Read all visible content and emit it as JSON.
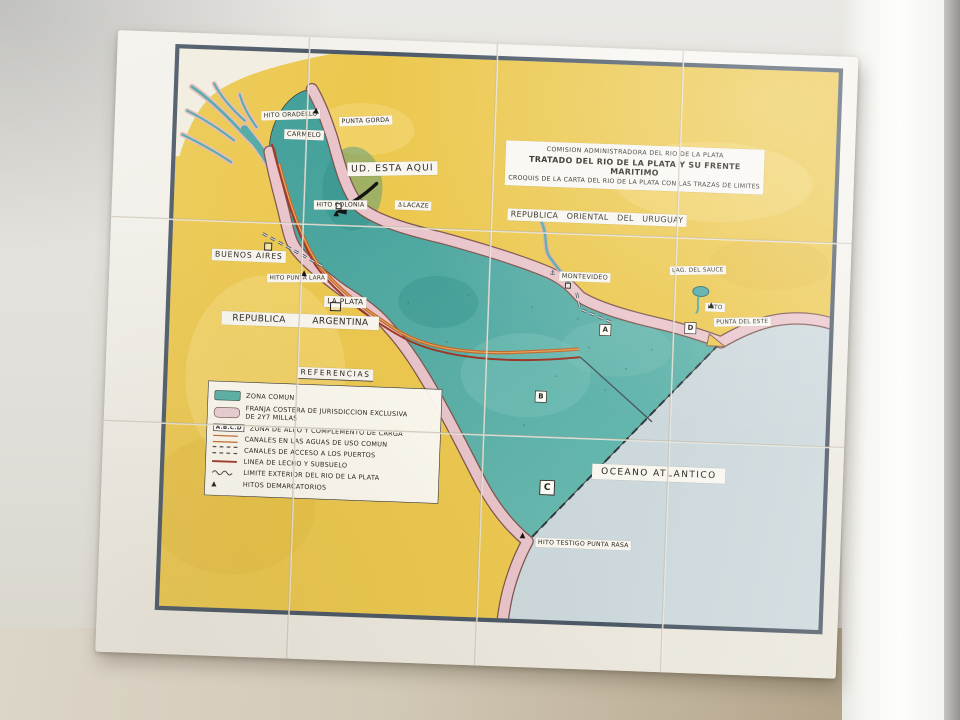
{
  "mural": {
    "title_box": {
      "line1": "COMISION ADMINISTRADORA DEL RIO DE LA PLATA",
      "line2": "TRATADO DEL RIO DE LA PLATA Y SU FRENTE MARITIMO",
      "line3": "CROQUIS DE LA CARTA DEL RIO DE LA PLATA CON LAS TRAZAS DE LIMITES"
    },
    "labels": {
      "republica_oriental": "REPUBLICA ORIENTAL DEL URUGUAY",
      "republica_argentina": "REPUBLICA ARGENTINA",
      "buenos_aires": "BUENOS AIRES",
      "hito_punta_lara": "HITO PUNTA LARA",
      "la_plata": "LA PLATA",
      "hito_oradello": "HITO ORADELLO",
      "punta_gorda": "PUNTA GORDA",
      "carmelo": "CARMELO",
      "ud_esta_aqui": "UD. ESTA AQUI",
      "hito_colonia": "HITO COLONIA",
      "lacaze": "LACAZE",
      "montevideo": "MONTEVIDEO",
      "lag_del_sauce": "LAG. DEL SAUCE",
      "hito_punta_del_este": "HITO",
      "punta_del_este": "PUNTA DEL ESTE",
      "oceano_atlantico": "OCEANO ATLANTICO",
      "hito_testigo_punta_rasa": "HITO TESTIGO PUNTA RASA"
    },
    "zone_markers": {
      "a": "A",
      "b": "B",
      "c": "C",
      "d": "D"
    },
    "icons": {
      "hito": "▲",
      "anchor": "⚓"
    },
    "legend": {
      "title": "REFERENCIAS",
      "abcd_box": "A.B.C.D",
      "items": [
        {
          "label": "ZONA COMUN"
        },
        {
          "label": "FRANJA COSTERA DE JURISDICCION EXCLUSIVA",
          "label2": "DE 2Y7 MILLAS"
        },
        {
          "label": "ZONA DE ALIJO Y COMPLEMENTO DE CARGA"
        },
        {
          "label": "CANALES EN LAS AGUAS DE USO COMUN"
        },
        {
          "label": "CANALES DE ACCESO A LOS PUERTOS"
        },
        {
          "label": "LINEA DE LECHO Y SUBSUELO"
        },
        {
          "label": "LIMITE EXTERIOR DEL RIO DE LA PLATA"
        },
        {
          "label": "HITOS DEMARCATORIOS"
        }
      ]
    },
    "colors": {
      "land": "#ecc84f",
      "river": "#51a8a1",
      "coastal_strip": "#e9c5cb",
      "ocean": "#ccd8dc",
      "map_border": "#3e4c5c",
      "channel": "#bf6a2c",
      "lecho": "#9e3526"
    }
  }
}
